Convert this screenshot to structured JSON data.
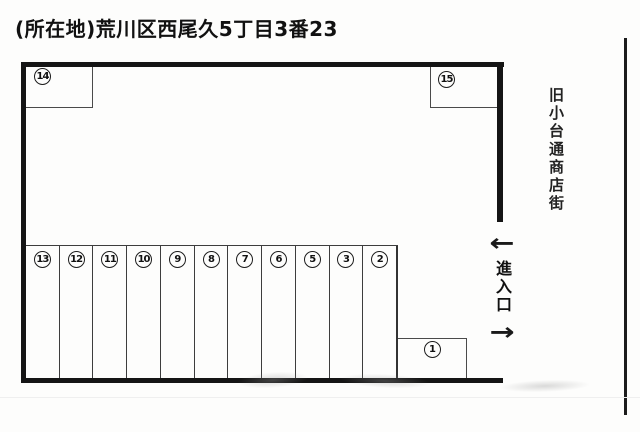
{
  "title": "(所在地)荒川区西尾久5丁目3番23",
  "side_labels": {
    "street_name": "旧小台通商店街",
    "entrance": "進入口",
    "arrow_in": "←",
    "arrow_out": "→"
  },
  "stalls": {
    "top_left": "14",
    "top_right": "15",
    "bottom_right": "1",
    "row": [
      "13",
      "12",
      "11",
      "10",
      "9",
      "8",
      "7",
      "6",
      "5",
      "3",
      "2"
    ]
  }
}
